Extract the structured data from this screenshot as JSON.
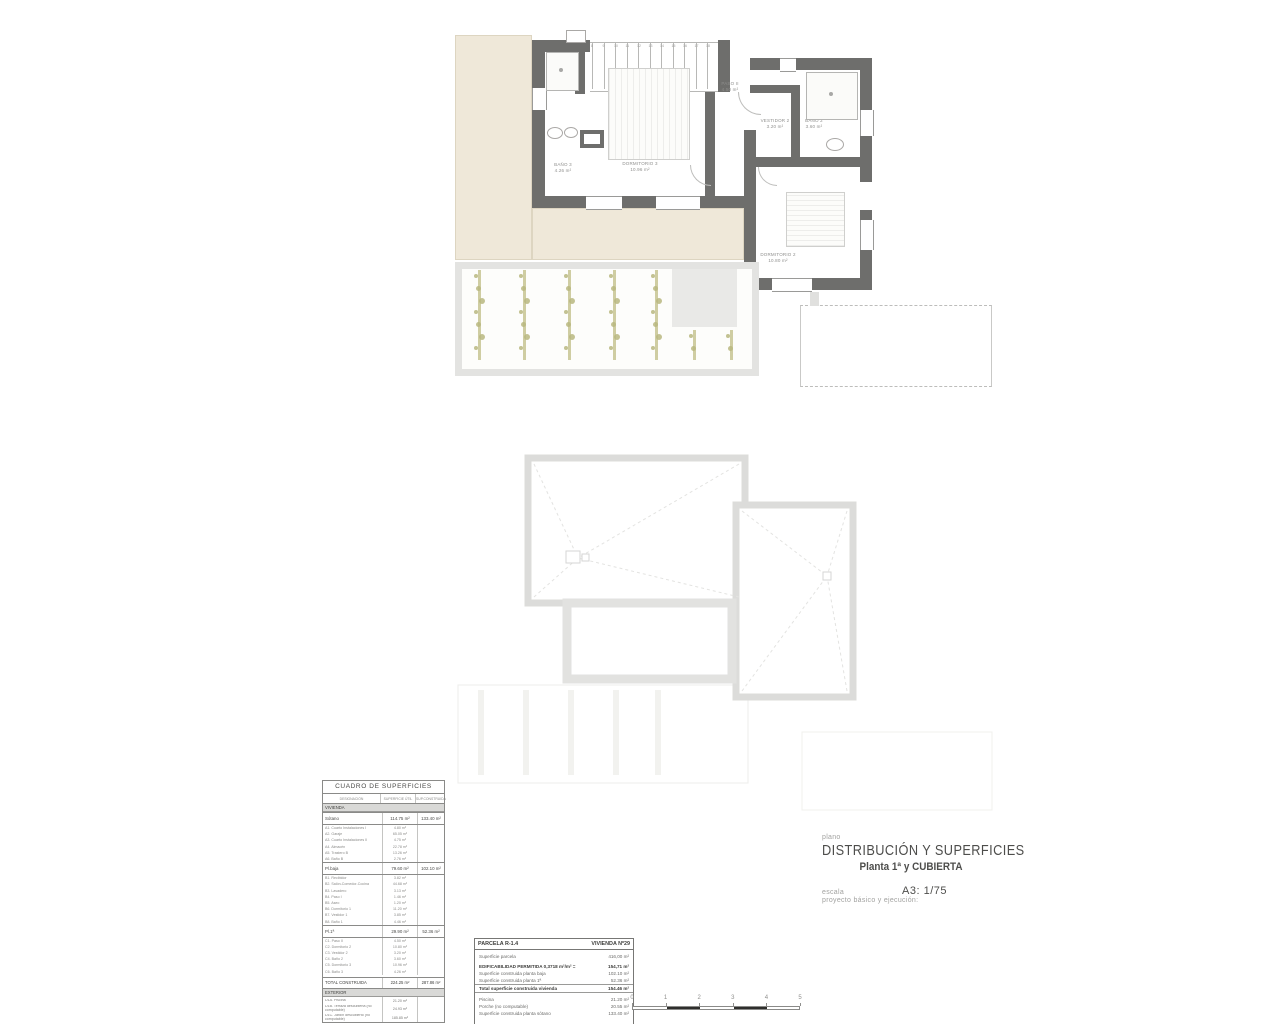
{
  "title_block": {
    "plano_label": "plano",
    "title": "DISTRIBUCIÓN Y SUPERFICIES",
    "subtitle": "Planta 1ª y CUBIERTA",
    "escala_label": "escala",
    "escala_value": "A3: 1/75",
    "project_note": "proyecto básico y ejecución:"
  },
  "floor_plan": {
    "rooms": [
      {
        "name": "paso-2",
        "label": "PASO II",
        "area": "4.50 m²"
      },
      {
        "name": "vestidor-2",
        "label": "VESTIDOR 2",
        "area": "3.20 m²"
      },
      {
        "name": "bano-2",
        "label": "BAÑO 2",
        "area": "3.60 m²"
      },
      {
        "name": "dormitorio-3",
        "label": "DORMITORIO 3",
        "area": "10.96 m²"
      },
      {
        "name": "bano-3",
        "label": "BAÑO 3",
        "area": "4.26 m²"
      },
      {
        "name": "dormitorio-2",
        "label": "DORMITORIO 2",
        "area": "10.80 m²"
      }
    ],
    "stair_numbers": [
      "8",
      "9",
      "10",
      "11",
      "12",
      "13",
      "14",
      "15",
      "16",
      "17",
      "18"
    ]
  },
  "surfaces_table": {
    "title": "CUADRO DE SUPERFICIES",
    "columns": [
      "DESIGNACIÓN",
      "SUPERFICIE ÚTIL",
      "SUP.CONSTRUIDA"
    ],
    "rows": [
      {
        "type": "band",
        "label": "VIVIENDA"
      },
      {
        "type": "grp",
        "label": "Sótano",
        "util": "114.75 m²",
        "built": "133.40 m²"
      },
      {
        "type": "sub",
        "label": "A1. Cuarto Instalaciones I",
        "util": "4.80 m²"
      },
      {
        "type": "sub",
        "label": "A2. Garaje",
        "util": "65.05 m²"
      },
      {
        "type": "sub",
        "label": "A3. Cuarto Instalaciones II",
        "util": "4.75 m²"
      },
      {
        "type": "sub",
        "label": "A4. Almacén",
        "util": "22.78 m²"
      },
      {
        "type": "sub",
        "label": "A5. Trastero B",
        "util": "13.26 m²"
      },
      {
        "type": "sub",
        "label": "A6. Baño B",
        "util": "2.76 m²"
      },
      {
        "type": "grp",
        "label": "Pl.baja",
        "util": "79.60 m²",
        "built": "102.10 m²"
      },
      {
        "type": "sub",
        "label": "B1. Recibidor",
        "util": "3.82 m²"
      },
      {
        "type": "sub",
        "label": "B2. Salón-Comedor-Cocina",
        "util": "44.68 m²"
      },
      {
        "type": "sub",
        "label": "B3. Lavadero",
        "util": "3.13 m²"
      },
      {
        "type": "sub",
        "label": "B4. Paso I",
        "util": "1.46 m²"
      },
      {
        "type": "sub",
        "label": "B5. Aseo",
        "util": "1.20 m²"
      },
      {
        "type": "sub",
        "label": "B6. Dormitorio 1",
        "util": "11.20 m²"
      },
      {
        "type": "sub",
        "label": "B7. Vestidor 1",
        "util": "3.85 m²"
      },
      {
        "type": "sub",
        "label": "B8. Baño 1",
        "util": "4.46 m²"
      },
      {
        "type": "grp",
        "label": "Pl.1ª",
        "util": "29.90 m²",
        "built": "52.36 m²"
      },
      {
        "type": "sub",
        "label": "C1. Paso II",
        "util": "4.50 m²"
      },
      {
        "type": "sub",
        "label": "C2. Dormitorio 2",
        "util": "10.80 m²"
      },
      {
        "type": "sub",
        "label": "C3. Vestidor 2",
        "util": "3.20 m²"
      },
      {
        "type": "sub",
        "label": "C4. Baño 2",
        "util": "3.60 m²"
      },
      {
        "type": "sub",
        "label": "C5. Dormitorio 3",
        "util": "10.96 m²"
      },
      {
        "type": "sub",
        "label": "C6. Baño 3",
        "util": "4.26 m²"
      },
      {
        "type": "tot",
        "label": "TOTAL CONSTRUIDA",
        "util": "224.25 m²",
        "built": "287.86 m²"
      },
      {
        "type": "band",
        "label": "EXTERIOR"
      },
      {
        "type": "sub2",
        "label": "D1A. Piscina",
        "util": "21.20 m²"
      },
      {
        "type": "sub2",
        "label": "D1B. Terraza descubierta (no computable)",
        "util": "24.93 m²"
      },
      {
        "type": "sub2",
        "label": "D1C. Jardín descubierto (no computable)",
        "util": "185.85 m²"
      }
    ]
  },
  "parcela_box": {
    "parcela": "PARCELA R-1.4",
    "vivienda": "VIVIENDA Nº29",
    "rows": [
      {
        "label": "Superficie parcela",
        "value": "416,00 m²",
        "style": "normal",
        "gap": true
      },
      {
        "label": "EDIFICABILIDAD PERMITIDA  0,3718 m²/m² =",
        "value": "154,71 m²",
        "style": "bold",
        "gap": true
      },
      {
        "label": "Superficie construida planta baja",
        "value": "102.10 m²",
        "style": "normal"
      },
      {
        "label": "Superficie construida planta 1ª",
        "value": "52.36 m²",
        "style": "normal"
      },
      {
        "label": "Total superficie construida vivienda",
        "value": "154.46 m²",
        "style": "bold",
        "rule": true
      },
      {
        "label": "Piscina",
        "value": "21.20 m²",
        "style": "normal",
        "gap": true
      },
      {
        "label": "Porche (no computable)",
        "value": "20.55 m²",
        "style": "normal"
      },
      {
        "label": "Superficie construida planta sótano",
        "value": "133.40 m²",
        "style": "normal"
      }
    ]
  },
  "scale_bar": {
    "labels": [
      "0",
      "1",
      "2",
      "3",
      "4",
      "5"
    ]
  },
  "colors": {
    "wall": "#6e6e6c",
    "terrace": "#efe8d9",
    "plant": "#b9b77f",
    "roof_line": "#dcdcda",
    "scale_black": "#2e2e2c"
  }
}
